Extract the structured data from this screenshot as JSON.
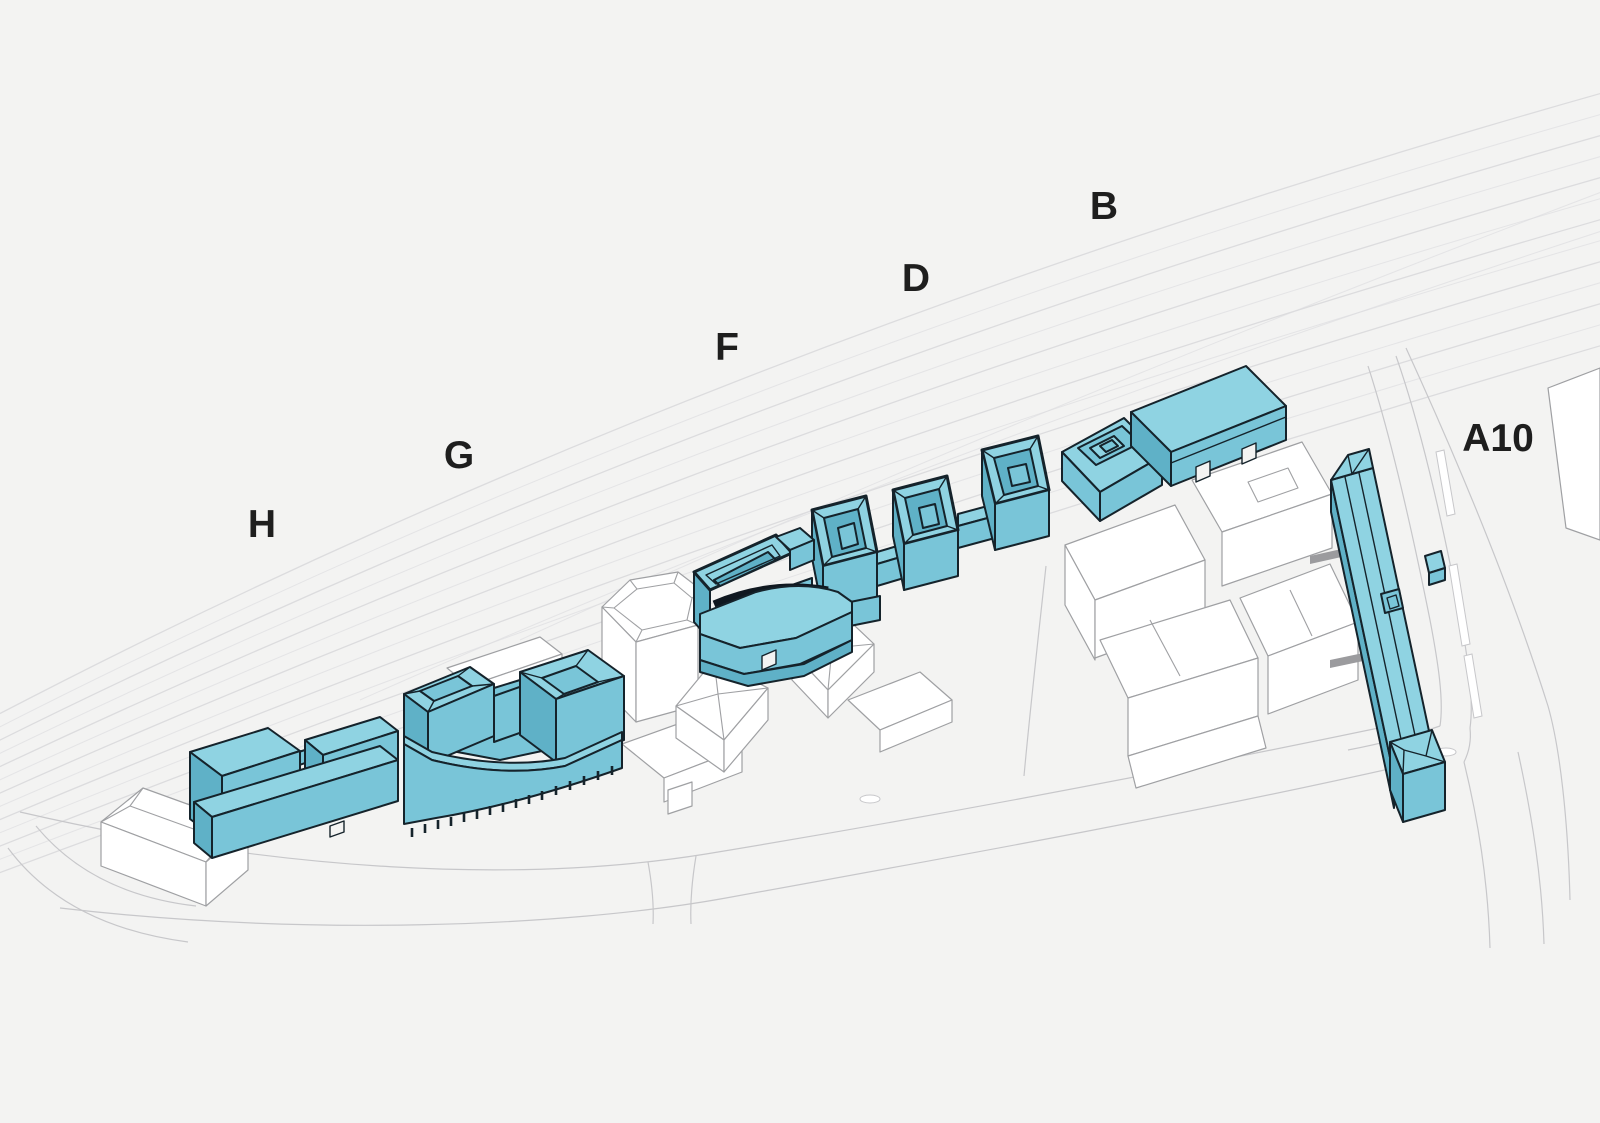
{
  "diagram": {
    "block_labels": [
      {
        "id": "B",
        "text": "B",
        "x": 1104,
        "y": 219
      },
      {
        "id": "D",
        "text": "D",
        "x": 916,
        "y": 291
      },
      {
        "id": "F",
        "text": "F",
        "x": 727,
        "y": 360
      },
      {
        "id": "G",
        "text": "G",
        "x": 459,
        "y": 468
      },
      {
        "id": "H",
        "text": "H",
        "x": 262,
        "y": 537
      },
      {
        "id": "A10",
        "text": "A10",
        "x": 1498,
        "y": 451
      }
    ],
    "colors": {
      "background": "#f3f3f2",
      "railway_line": "#dcdcde",
      "road_line": "#c7c7ca",
      "context_fill": "#ffffff",
      "context_stroke": "#9fa0a3",
      "highlight_roof": "#8fd3e2",
      "highlight_face": "#79c5d8",
      "highlight_shadow": "#5fb1c7",
      "outline_ink": "#15232b",
      "courtyard_dark": "#0f1a20",
      "bridge_gray": "#9b9b9e",
      "label_ink": "#1e1e1e"
    }
  }
}
